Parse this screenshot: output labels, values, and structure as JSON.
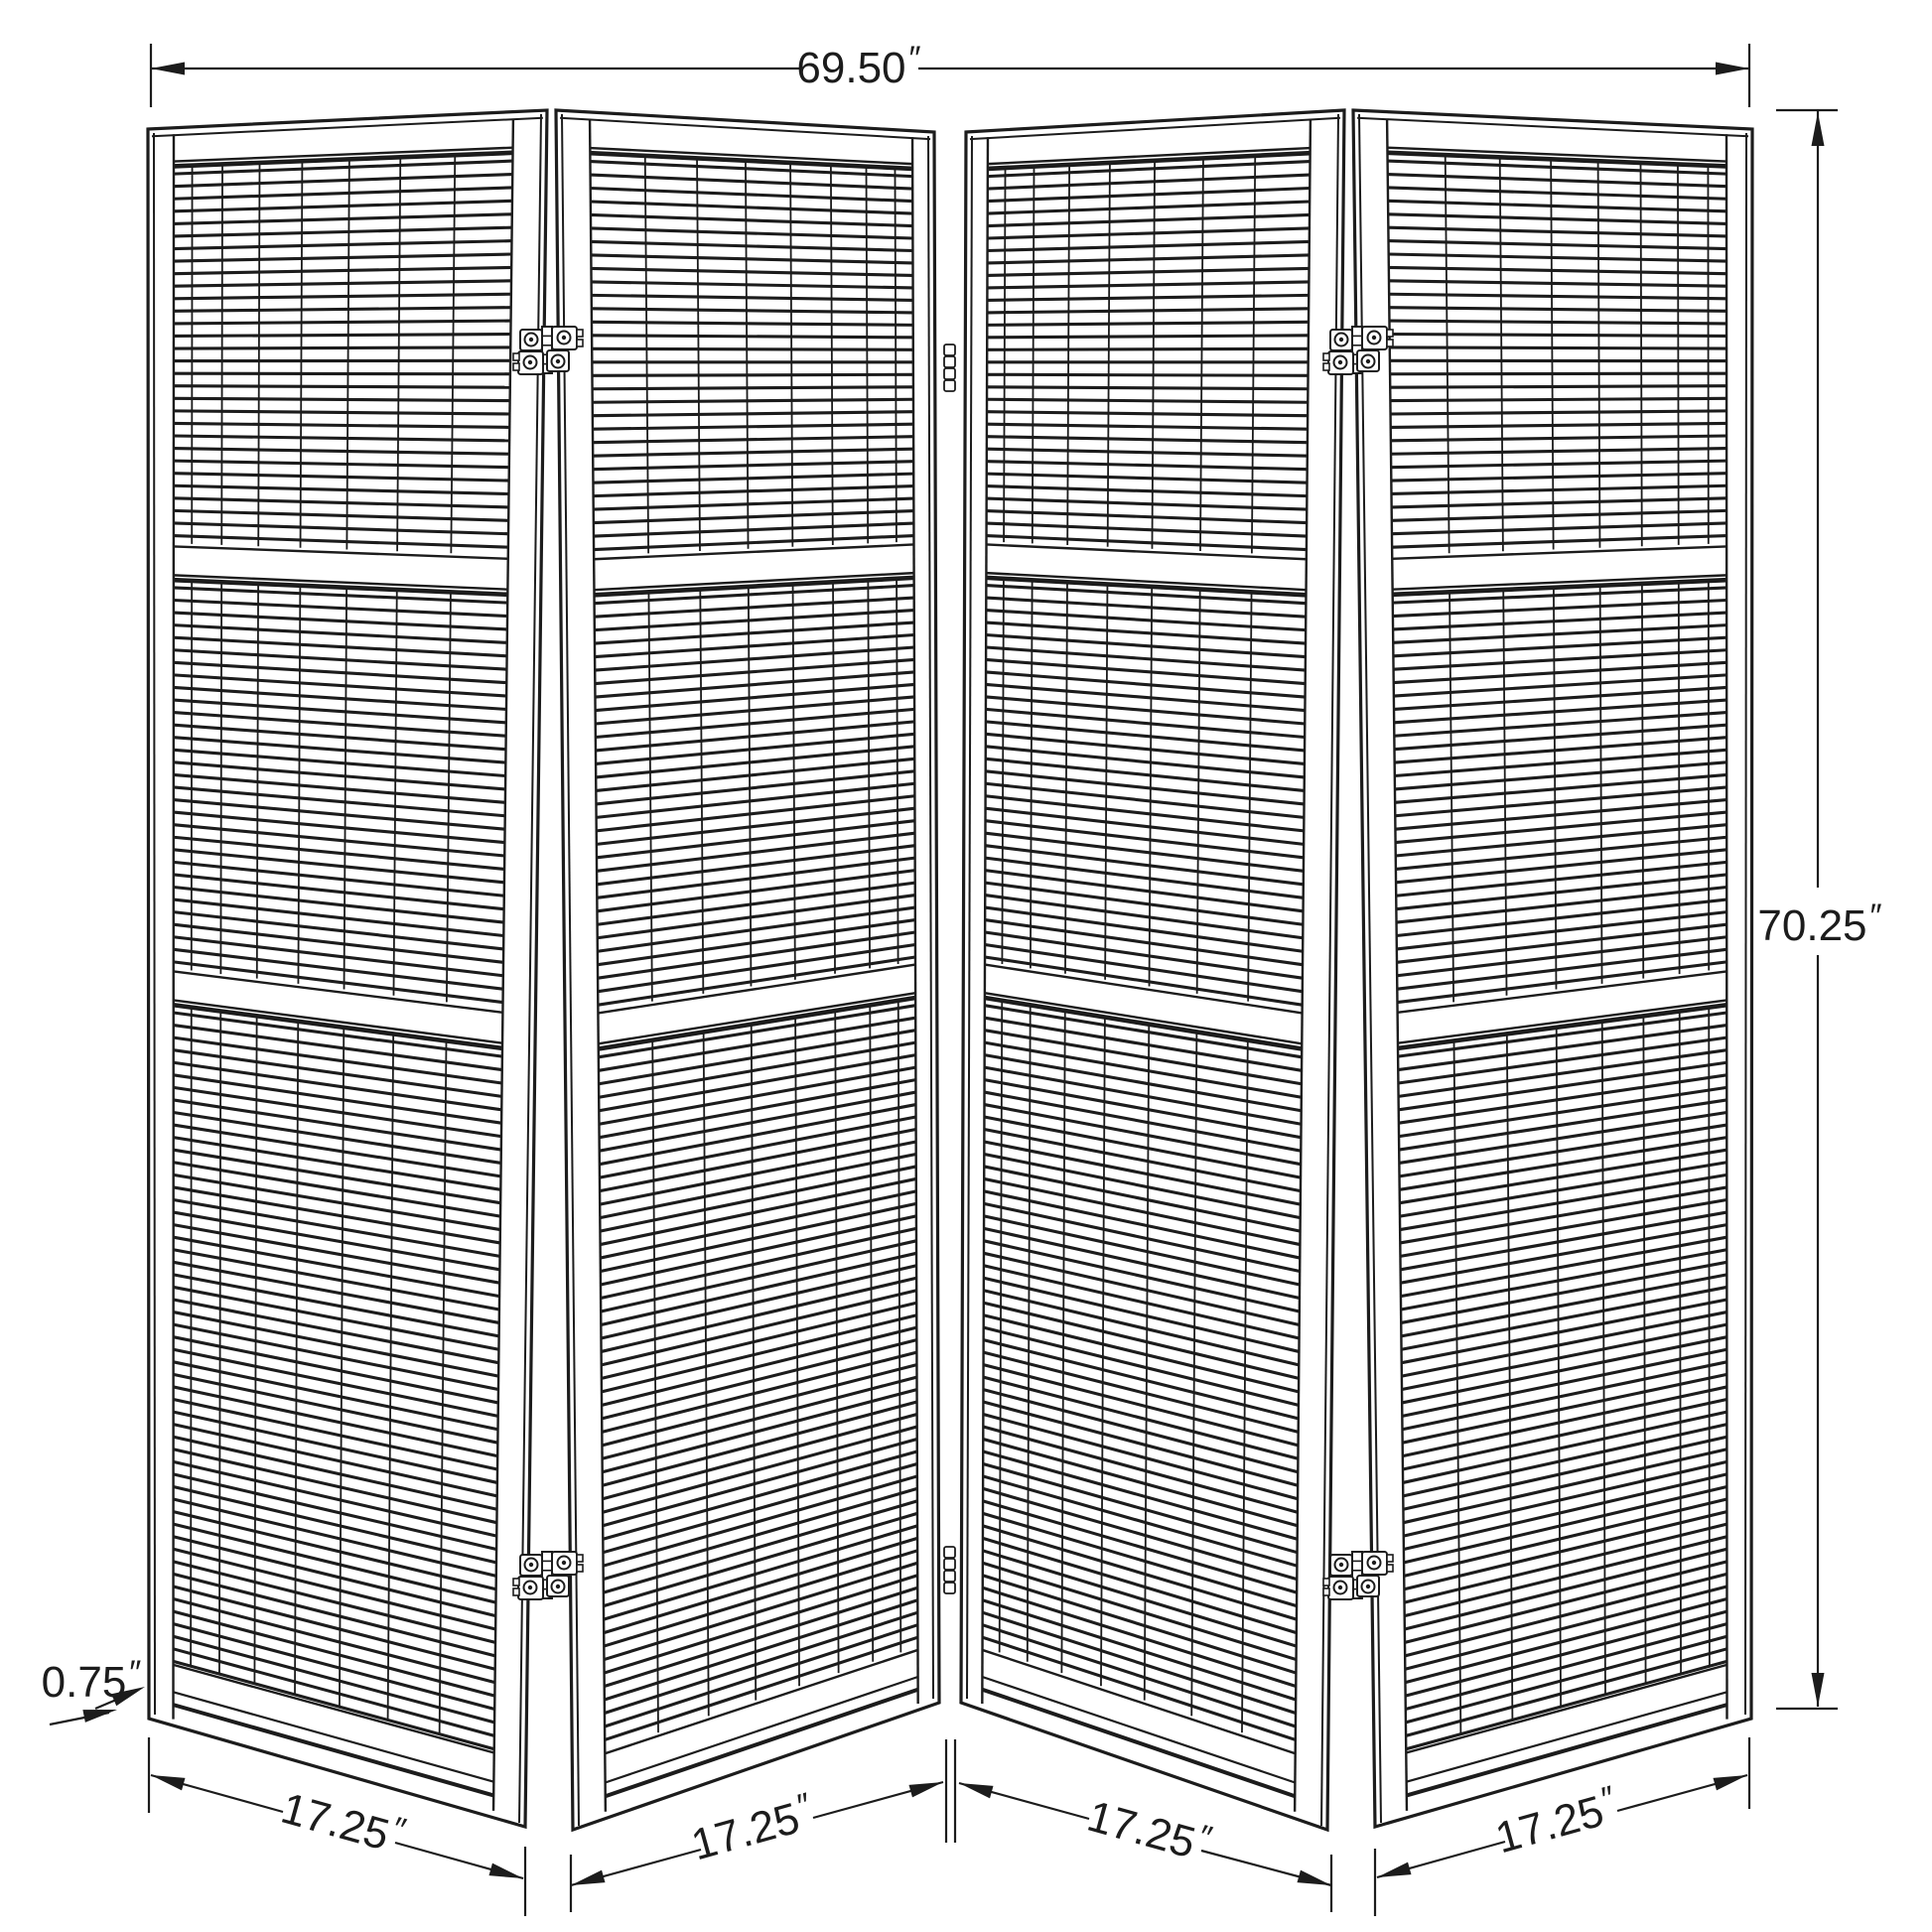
{
  "figure": {
    "type": "furniture-dimension-diagram",
    "subject": "4-panel folding screen room divider",
    "panels_count": 4,
    "colors": {
      "line": "#1c1c1c",
      "background": "#ffffff"
    },
    "dimensions": {
      "overall_width": {
        "value": "69.50",
        "unit": "″"
      },
      "overall_height": {
        "value": "70.25",
        "unit": "″"
      },
      "panel_thickness": {
        "value": "0.75",
        "unit": "″"
      },
      "panel_widths": [
        {
          "value": "17.25",
          "unit": "″"
        },
        {
          "value": "17.25",
          "unit": "″"
        },
        {
          "value": "17.25",
          "unit": "″"
        },
        {
          "value": "17.25",
          "unit": "″"
        }
      ]
    }
  }
}
